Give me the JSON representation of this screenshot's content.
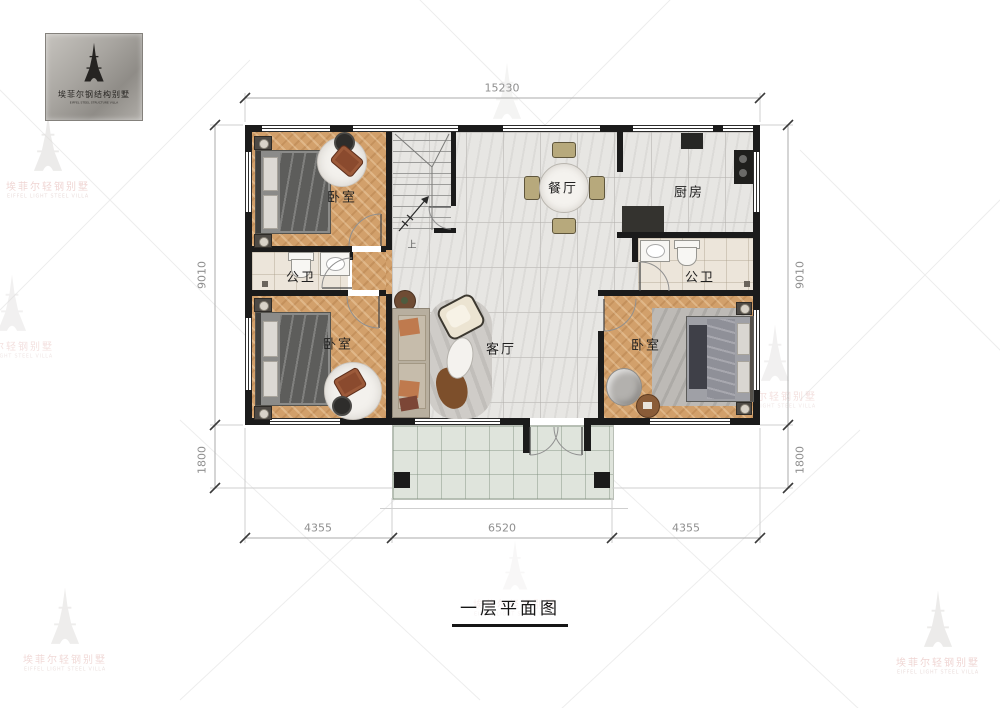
{
  "logo": {
    "brand_cn": "埃菲尔钢结构别墅",
    "brand_en": "EIFFEL STEEL STRUCTURE VILLA"
  },
  "watermark": {
    "cn": "埃菲尔轻钢别墅",
    "en": "EIFFEL LIGHT STEEL VILLA"
  },
  "title": {
    "text": "一层平面图"
  },
  "rooms": {
    "bedroom_tl": "卧室",
    "bath_l": "公卫",
    "bedroom_bl": "卧室",
    "dining": "餐厅",
    "living": "客厅",
    "kitchen": "厨房",
    "bath_r": "公卫",
    "bedroom_br": "卧室",
    "stair_up": "上"
  },
  "dimensions": {
    "top": "15230",
    "bottom_left": "4355",
    "bottom_center": "6520",
    "bottom_right": "4355",
    "left_upper": "9010",
    "left_lower": "1800",
    "right_upper": "9010",
    "right_lower": "1800"
  },
  "colors": {
    "wall": "#1b1b1b",
    "wood_floor": "#d2a06b",
    "marble_floor": "#e7e6e3",
    "porch_floor": "#dfe4dc",
    "bath_floor": "#ece5da",
    "dim_text": "#8f8f8f",
    "watermark_pink": "#e3b4b0",
    "logo_metal": "#a9a6a1"
  }
}
